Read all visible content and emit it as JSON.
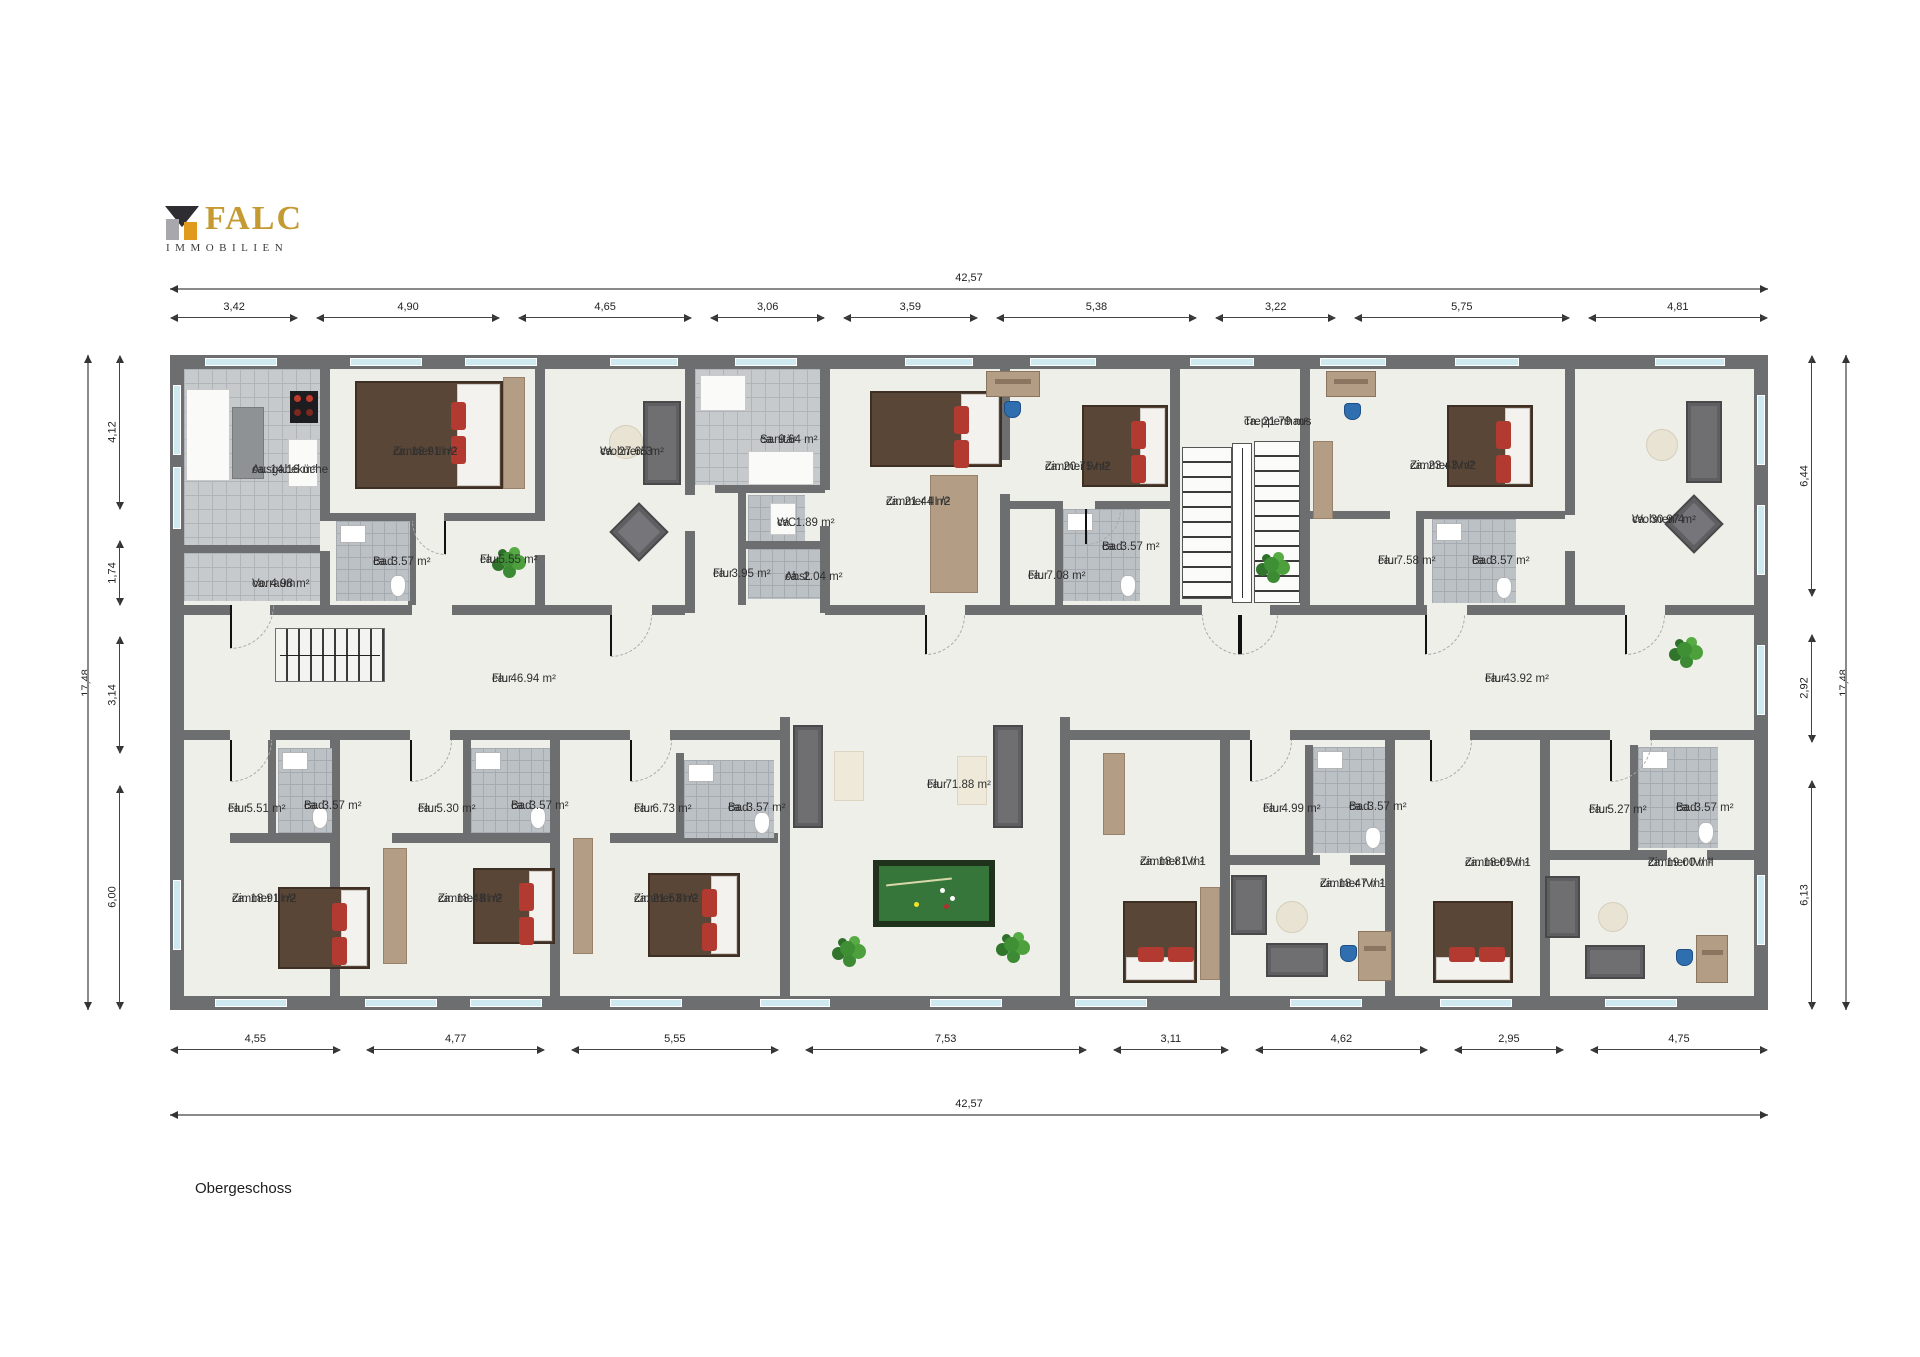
{
  "logo": {
    "brand": "FALC",
    "subtitle": "IMMOBILIEN",
    "brand_color": "#c59a33",
    "icon_gold": "#e09a1e"
  },
  "floor_label": "Obergeschoss",
  "dimensions": {
    "top": {
      "total": "42,57",
      "segments": [
        "3,42",
        "4,90",
        "4,65",
        "3,06",
        "3,59",
        "5,38",
        "3,22",
        "5,75",
        "4,81"
      ]
    },
    "bottom": {
      "total": "42,57",
      "segments": [
        "4,55",
        "4,77",
        "5,55",
        "7,53",
        "3,11",
        "4,62",
        "2,95",
        "4,75"
      ]
    },
    "left": {
      "total": "17,48",
      "segments": [
        "4,12",
        "1,74",
        "3,14",
        "6,00"
      ]
    },
    "right": {
      "total": "17,48",
      "segments": [
        "6,44",
        "2,92",
        "6,13"
      ]
    }
  },
  "rooms": [
    {
      "name": "Ausgabeküche",
      "area": "ca. 14.16 m²",
      "x": 82,
      "y": 108
    },
    {
      "name": "Vorraum",
      "area": "ca. 4.98 m²",
      "x": 82,
      "y": 222
    },
    {
      "name": "Zimmer III /2",
      "area": "ca. 18.91 m²",
      "x": 223,
      "y": 90
    },
    {
      "name": "Wohnen 3",
      "area": "ca. 27.65 m²",
      "x": 430,
      "y": 90
    },
    {
      "name": "Bad",
      "area": "ca. 3.57 m²",
      "x": 203,
      "y": 200
    },
    {
      "name": "Flur",
      "area": "ca. 5.55 m²",
      "x": 310,
      "y": 198
    },
    {
      "name": "Sanitär",
      "area": "ca. 9.64 m²",
      "x": 590,
      "y": 78
    },
    {
      "name": "WC",
      "area": "ca. 1.89 m²",
      "x": 607,
      "y": 161
    },
    {
      "name": "Flur",
      "area": "ca. 3.95 m²",
      "x": 543,
      "y": 212
    },
    {
      "name": "Abst.",
      "area": "ca. 2.04 m²",
      "x": 615,
      "y": 215
    },
    {
      "name": "Zimmer III /2",
      "area": "ca. 21.44 m²",
      "x": 716,
      "y": 140
    },
    {
      "name": "Zimmer IV /2",
      "area": "ca. 20.75 m²",
      "x": 875,
      "y": 105
    },
    {
      "name": "Flur",
      "area": "ca. 7.08 m²",
      "x": 858,
      "y": 214
    },
    {
      "name": "Bad",
      "area": "ca. 3.57 m²",
      "x": 932,
      "y": 185
    },
    {
      "name": "Treppenhaus",
      "area": "ca. 21.79 m²",
      "x": 1074,
      "y": 60
    },
    {
      "name": "Zimmer IV /2",
      "area": "ca. 23.43 m²",
      "x": 1240,
      "y": 104
    },
    {
      "name": "Flur",
      "area": "ca. 7.58 m²",
      "x": 1208,
      "y": 199
    },
    {
      "name": "Bad",
      "area": "ca. 3.57 m²",
      "x": 1302,
      "y": 199
    },
    {
      "name": "Wohnen 4",
      "area": "ca. 30.97 m²",
      "x": 1462,
      "y": 158
    },
    {
      "name": "Flur",
      "area": "ca. 46.94 m²",
      "x": 322,
      "y": 317
    },
    {
      "name": "Flur",
      "area": "ca. 43.92 m²",
      "x": 1315,
      "y": 317
    },
    {
      "name": "Flur",
      "area": "ca. 71.88 m²",
      "x": 757,
      "y": 423
    },
    {
      "name": "Flur",
      "area": "ca. 5.51 m²",
      "x": 58,
      "y": 447
    },
    {
      "name": "Bad",
      "area": "ca. 3.57 m²",
      "x": 134,
      "y": 444
    },
    {
      "name": "Zimmer III /2",
      "area": "ca. 18.91 m²",
      "x": 62,
      "y": 537
    },
    {
      "name": "Flur",
      "area": "ca. 5.30 m²",
      "x": 248,
      "y": 447
    },
    {
      "name": "Bad",
      "area": "ca. 3.57 m²",
      "x": 341,
      "y": 444
    },
    {
      "name": "Zimmer III /2",
      "area": "ca. 18.48 m²",
      "x": 268,
      "y": 537
    },
    {
      "name": "Flur",
      "area": "ca. 6.73 m²",
      "x": 464,
      "y": 447
    },
    {
      "name": "Bad",
      "area": "ca. 3.57 m²",
      "x": 558,
      "y": 446
    },
    {
      "name": "Zimmer III /2",
      "area": "ca. 21.53 m²",
      "x": 464,
      "y": 537
    },
    {
      "name": "Zimmer IV/ 1",
      "area": "ca. 18.81 m²",
      "x": 970,
      "y": 500
    },
    {
      "name": "Flur",
      "area": "ca. 4.99 m²",
      "x": 1093,
      "y": 447
    },
    {
      "name": "Bad",
      "area": "ca. 3.57 m²",
      "x": 1179,
      "y": 445
    },
    {
      "name": "Zimmer IV/ 1",
      "area": "ca. 18.47 m²",
      "x": 1150,
      "y": 522
    },
    {
      "name": "Zimmer IV/ 1",
      "area": "ca. 18.05 m²",
      "x": 1295,
      "y": 501
    },
    {
      "name": "Flur",
      "area": "ca. 5.27 m²",
      "x": 1419,
      "y": 448
    },
    {
      "name": "Bad",
      "area": "ca. 3.57 m²",
      "x": 1506,
      "y": 446
    },
    {
      "name": "Zimmer IV/ II",
      "area": "ca. 19.00 m²",
      "x": 1478,
      "y": 501
    }
  ]
}
